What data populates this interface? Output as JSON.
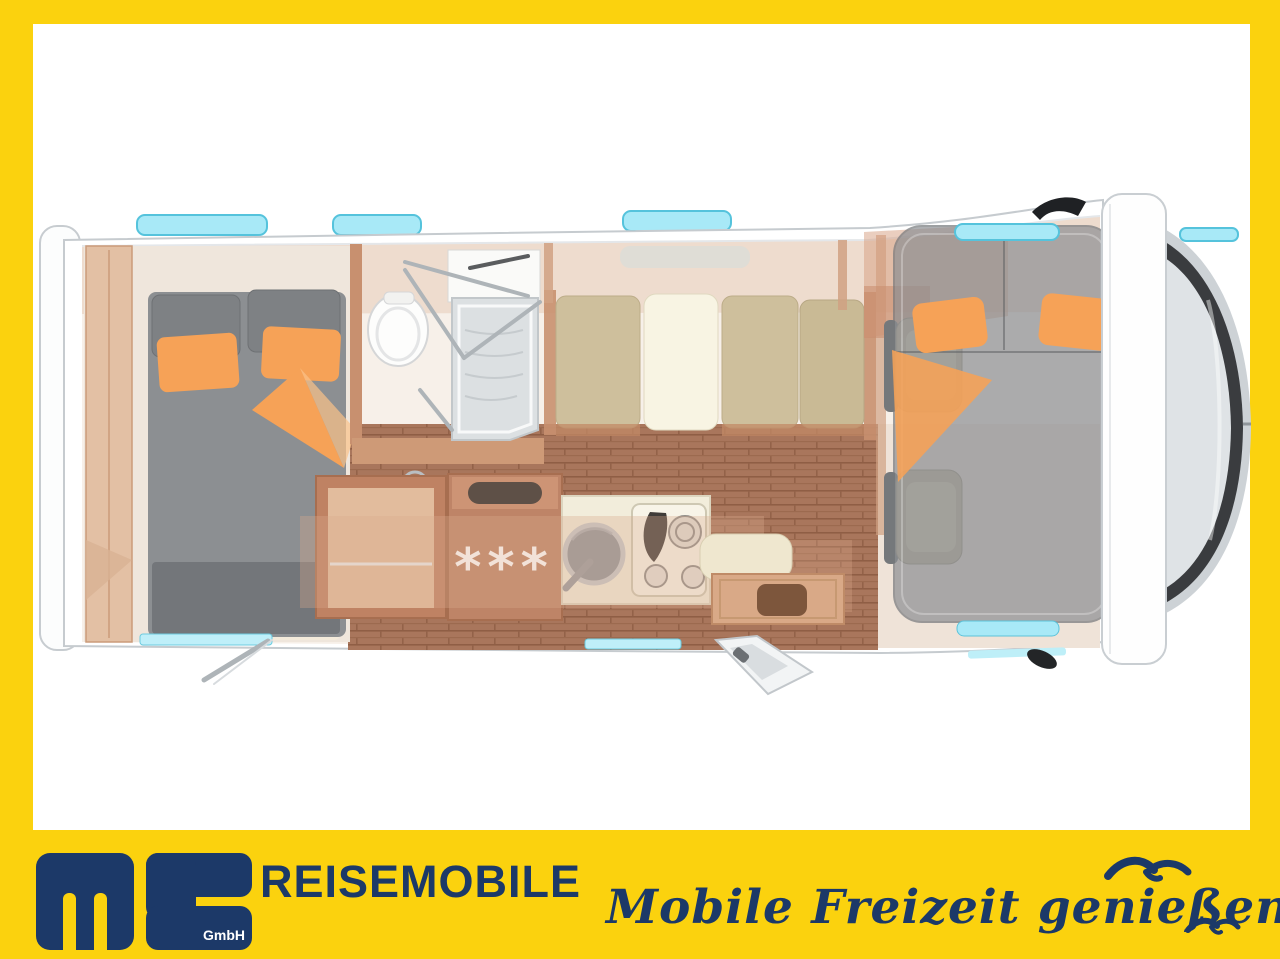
{
  "branding": {
    "monogram": "MS",
    "monogram_suffix": "GmbH",
    "wordmark": "REISEMOBILE",
    "slogan": "Mobile Freizeit genießen."
  },
  "floorplan": {
    "fridge_label": "***"
  },
  "colors": {
    "brand_yellow": "#FBD20E",
    "brand_navy": "#1C3968",
    "skylight_cyan": "#A8E9F7",
    "accent_orange": "#F6A257",
    "wood": "#C8906F",
    "bed_gray": "#8C8F92"
  }
}
